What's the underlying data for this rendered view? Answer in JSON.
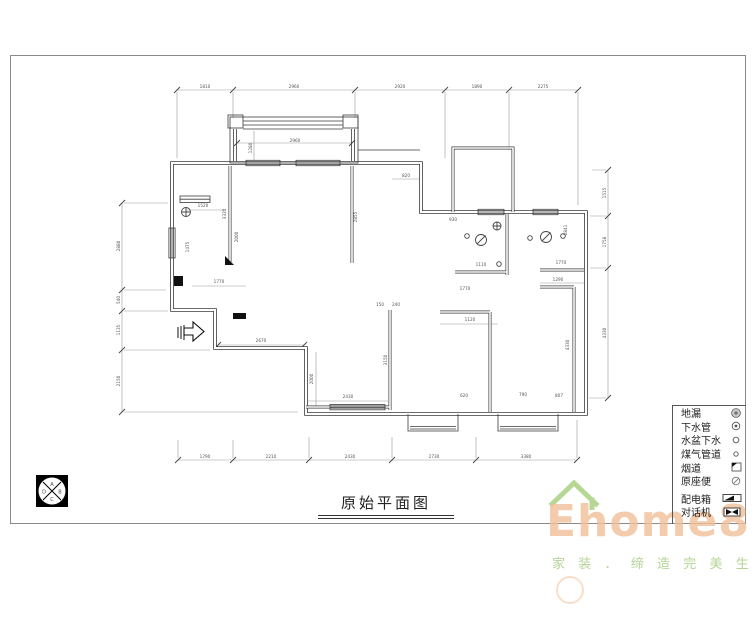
{
  "title": {
    "text": "原始平面图"
  },
  "compass": {
    "letters": {
      "top": "A",
      "right": "B",
      "bottom": "C",
      "left": "D"
    }
  },
  "legend": {
    "items": [
      {
        "label": "地漏",
        "icon": "floor-drain"
      },
      {
        "label": "下水管",
        "icon": "drain-pipe"
      },
      {
        "label": "水盆下水",
        "icon": "basin-drain"
      },
      {
        "label": "煤气管道",
        "icon": "gas-pipe"
      },
      {
        "label": "烟道",
        "icon": "flue"
      },
      {
        "label": "原座便",
        "icon": "original-toilet"
      },
      {
        "label": "配电箱",
        "icon": "distribution-box"
      },
      {
        "label": "对话机",
        "icon": "intercom"
      }
    ]
  },
  "watermark": {
    "brand": "Ehome8",
    "tagline": "家 装 ． 缔 造 完 美 生 活",
    "brand_color": "#f1c09a",
    "accent_color": "#b7d795"
  },
  "plan": {
    "dims_top": [
      "1810",
      "2960",
      "2920",
      "1890",
      "2275"
    ],
    "dims_bottom": [
      "1790",
      "2210",
      "2430",
      "2730",
      "3380"
    ],
    "dims_left": [
      "2880",
      "540",
      "1135",
      "2150"
    ],
    "dims_right": [
      "1515",
      "1758",
      "4330"
    ],
    "inner_dims": [
      "2960",
      "1280",
      "820",
      "3320",
      "2855",
      "1520",
      "1475",
      "1770",
      "2670",
      "2000",
      "2430",
      "3150",
      "1120",
      "1110",
      "1770",
      "1770",
      "1290",
      "4330",
      "2841",
      "930",
      "620",
      "790",
      "807",
      "2000",
      "150",
      "240"
    ]
  }
}
